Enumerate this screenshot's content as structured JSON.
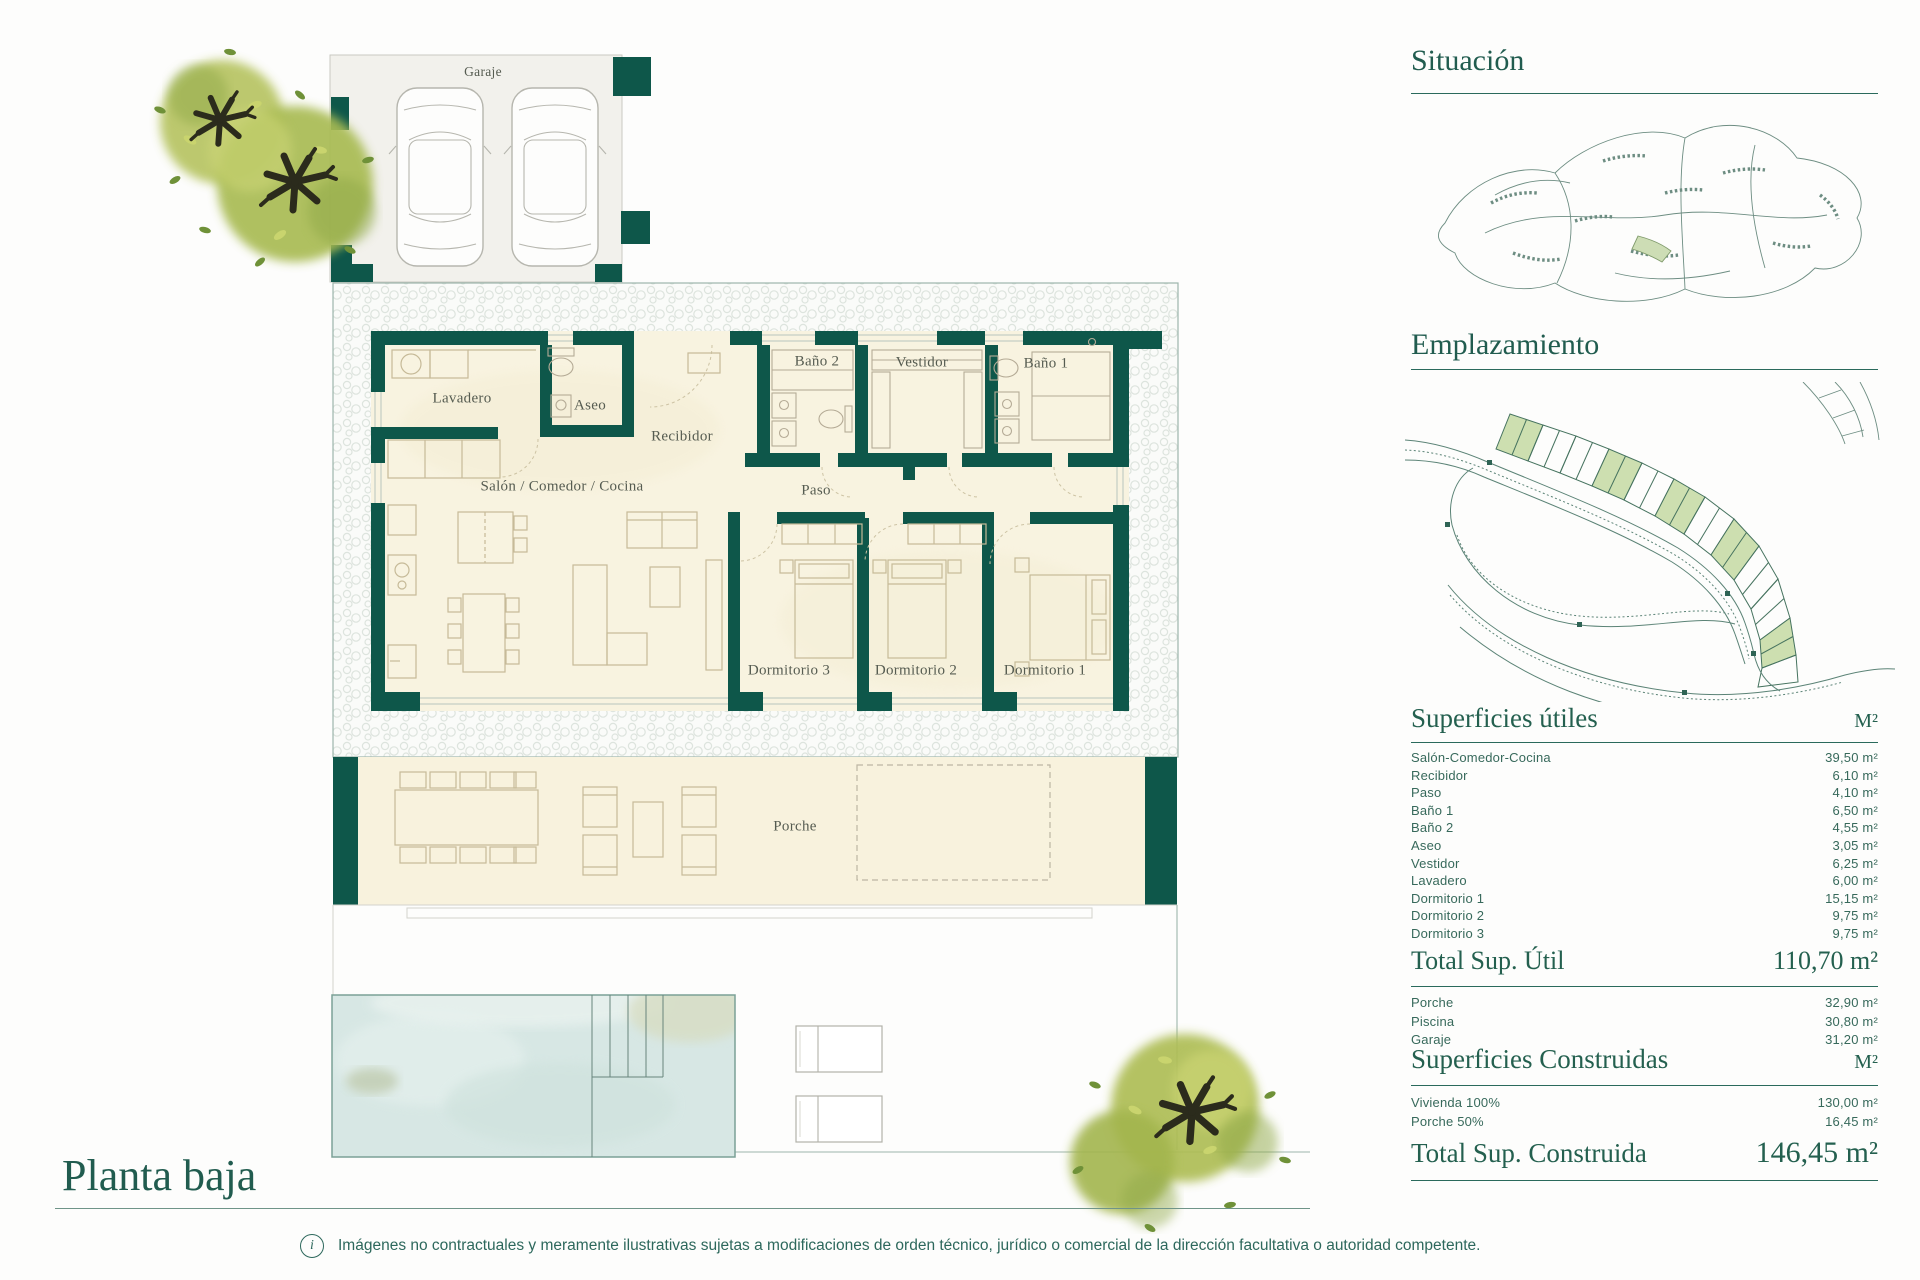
{
  "plan": {
    "title": "Planta baja",
    "rooms": {
      "garaje": "Garaje",
      "lavadero": "Lavadero",
      "aseo": "Aseo",
      "recibidor": "Recibidor",
      "salon": "Salón / Comedor / Cocina",
      "bano2": "Baño 2",
      "vestidor": "Vestidor",
      "bano1": "Baño 1",
      "paso": "Paso",
      "dormitorio3": "Dormitorio 3",
      "dormitorio2": "Dormitorio 2",
      "dormitorio1": "Dormitorio 1",
      "porche": "Porche"
    }
  },
  "sidebar": {
    "situacion_title": "Situación",
    "emplazamiento_title": "Emplazamiento",
    "utiles": {
      "title": "Superficies útiles",
      "unit": "M²",
      "rows": [
        {
          "label": "Salón-Comedor-Cocina",
          "value": "39,50 m²"
        },
        {
          "label": "Recibidor",
          "value": "6,10 m²"
        },
        {
          "label": "Paso",
          "value": "4,10 m²"
        },
        {
          "label": "Baño 1",
          "value": "6,50 m²"
        },
        {
          "label": "Baño 2",
          "value": "4,55 m²"
        },
        {
          "label": "Aseo",
          "value": "3,05 m²"
        },
        {
          "label": "Vestidor",
          "value": "6,25 m²"
        },
        {
          "label": "Lavadero",
          "value": "6,00 m²"
        },
        {
          "label": "Dormitorio 1",
          "value": "15,15 m²"
        },
        {
          "label": "Dormitorio 2",
          "value": "9,75 m²"
        },
        {
          "label": "Dormitorio 3",
          "value": "9,75 m²"
        }
      ],
      "total_label": "Total Sup. Útil",
      "total_value": "110,70 m²"
    },
    "extras": [
      {
        "label": "Porche",
        "value": "32,90 m²"
      },
      {
        "label": "Piscina",
        "value": "30,80 m²"
      },
      {
        "label": "Garaje",
        "value": "31,20 m²"
      }
    ],
    "construidas": {
      "title": "Superficies Construidas",
      "unit": "M²",
      "rows": [
        {
          "label": "Vivienda 100%",
          "value": "130,00 m²"
        },
        {
          "label": "Porche 50%",
          "value": "16,45 m²"
        }
      ],
      "total_label": "Total Sup. Construida",
      "total_value": "146,45 m²"
    }
  },
  "footer": {
    "disclaimer": "Imágenes no contractuales y meramente ilustrativas sujetas a modificaciones de orden técnico, jurídico o comercial de la dirección facultativa o autoridad competente."
  },
  "colors": {
    "wall_teal": "#0e574a",
    "heading_teal": "#24604f",
    "table_text": "#37695b",
    "floor_cream": "#f8f3e0",
    "pool_blue": "#d7e7e4",
    "plot_green": "#cddfb0"
  }
}
